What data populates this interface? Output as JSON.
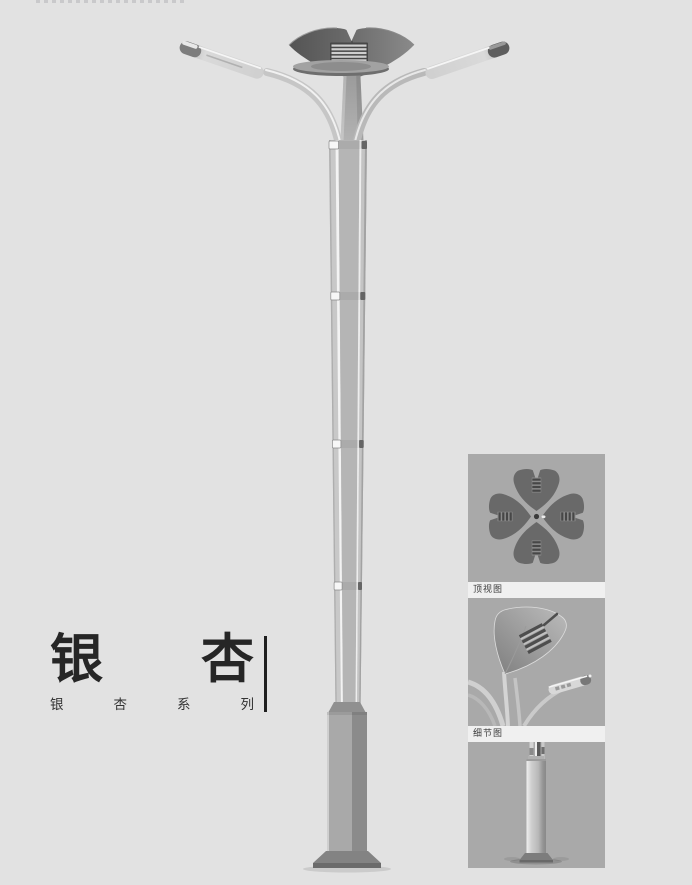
{
  "page": {
    "background_color": "#e2e2e2",
    "text_color": "#262626"
  },
  "title_block": {
    "title": "银杏",
    "title_chars": [
      "银",
      "杏"
    ],
    "subtitle": "银杏系列",
    "subtitle_chars": [
      "银",
      "杏",
      "系",
      "列"
    ]
  },
  "gallery": {
    "items": [
      {
        "id": "top-view",
        "label": "顶视图"
      },
      {
        "id": "detail-view",
        "label": "细节图"
      },
      {
        "id": "base-view",
        "label": ""
      }
    ]
  },
  "illustration": {
    "subject": "ginkgo-leaf double-arm street lamp, front elevation with segmented tapered pole and square base",
    "colors": {
      "leaf_dark": "#5f5f5f",
      "metal_light": "#d6d6d6",
      "pole_mid": "#b5b5b5",
      "base_gray": "#9a9a9a",
      "thumb_background": "#a9a9a9",
      "label_strip": "#f0f0f0"
    }
  }
}
